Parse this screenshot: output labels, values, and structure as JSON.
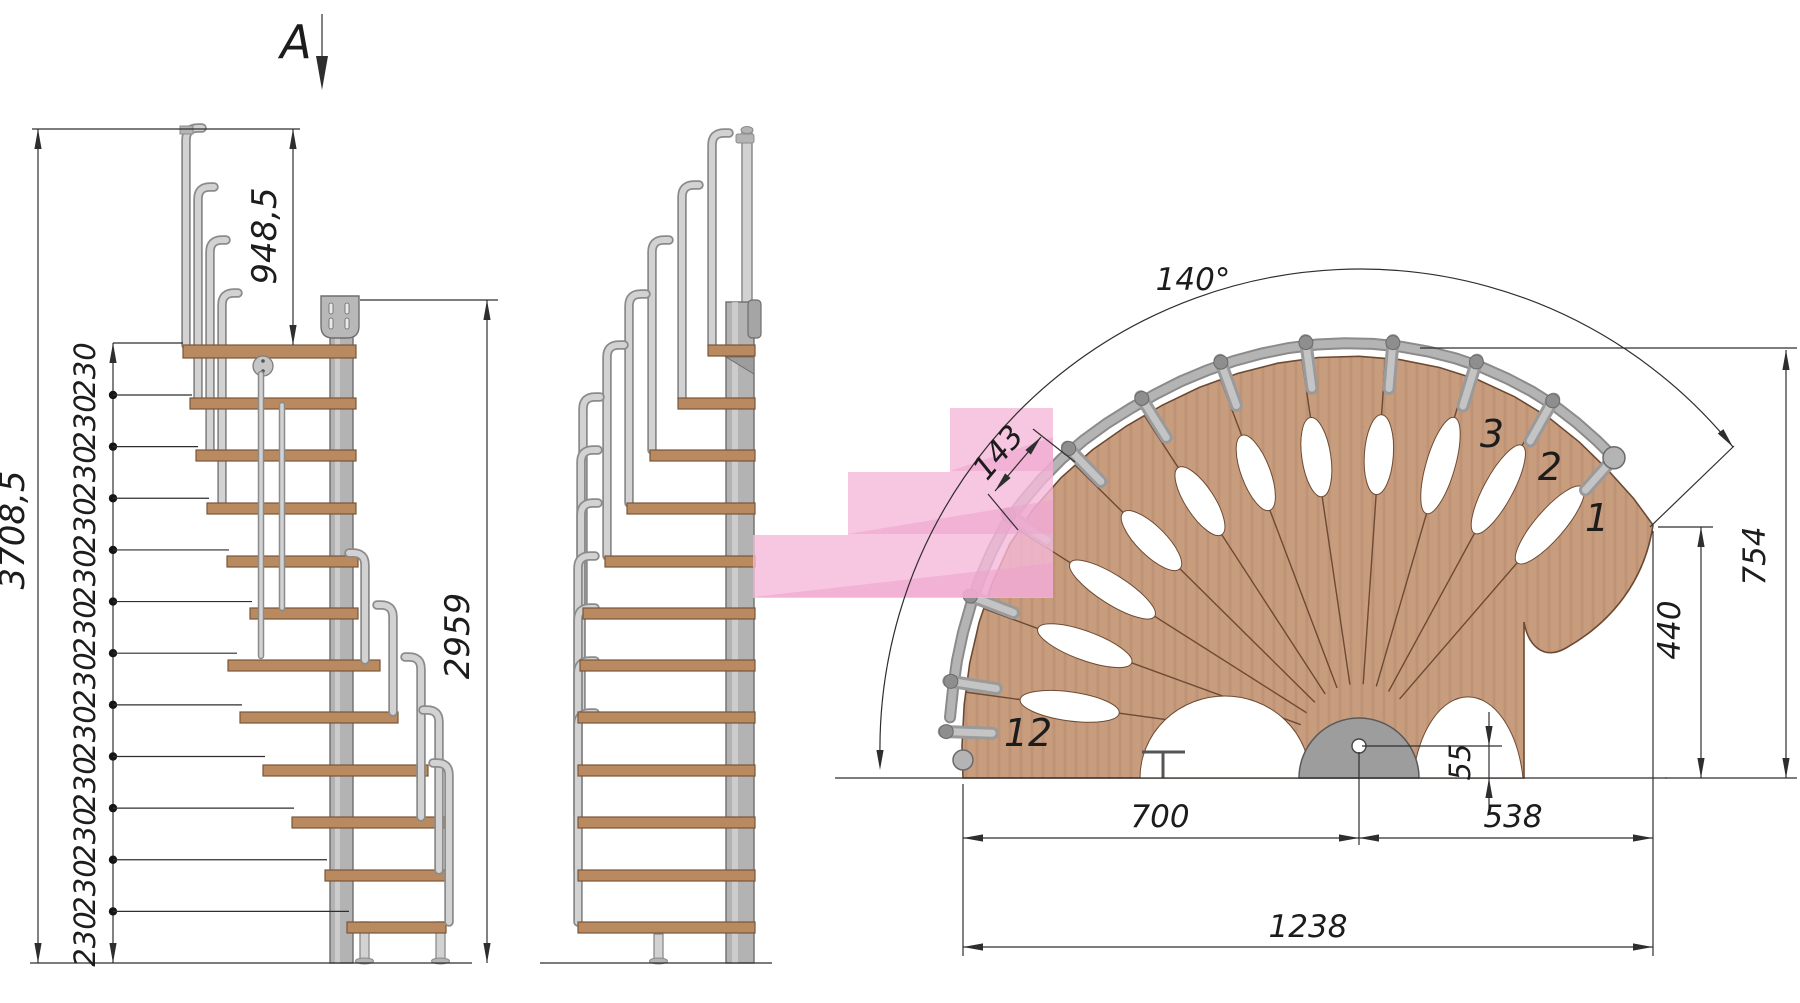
{
  "section_marker": {
    "label": "A"
  },
  "left_view": {
    "overall_height": "3708,5",
    "upper_height": "948,5",
    "mount_height": "2959",
    "rise_labels": [
      "230",
      "230",
      "230",
      "230",
      "230",
      "230",
      "230",
      "230",
      "230",
      "230",
      "230",
      "230"
    ]
  },
  "plan_view": {
    "sweep_angle": "140°",
    "tread_width": "143",
    "height_right": "754",
    "tip_height": "440",
    "pole_offset": "55",
    "span_left": "700",
    "span_right": "538",
    "span_total": "1238",
    "step_numbers": [
      "1",
      "2",
      "3",
      "12"
    ]
  },
  "colors": {
    "line": "#2e2e2e",
    "wood_side": "#b9895f",
    "wood_side_edge": "#7a563a",
    "wood_fan": "#c89d7d",
    "wood_fan_edge": "#6d4a33",
    "metal_light": "#d2d2d2",
    "metal_mid": "#b4b4b4",
    "metal_dark": "#8b8b8b",
    "pole": "#b3b3b3",
    "pole_edge": "#6e6e6e",
    "pink": "#f5b8d8",
    "pink_dark": "#eda3cc"
  }
}
